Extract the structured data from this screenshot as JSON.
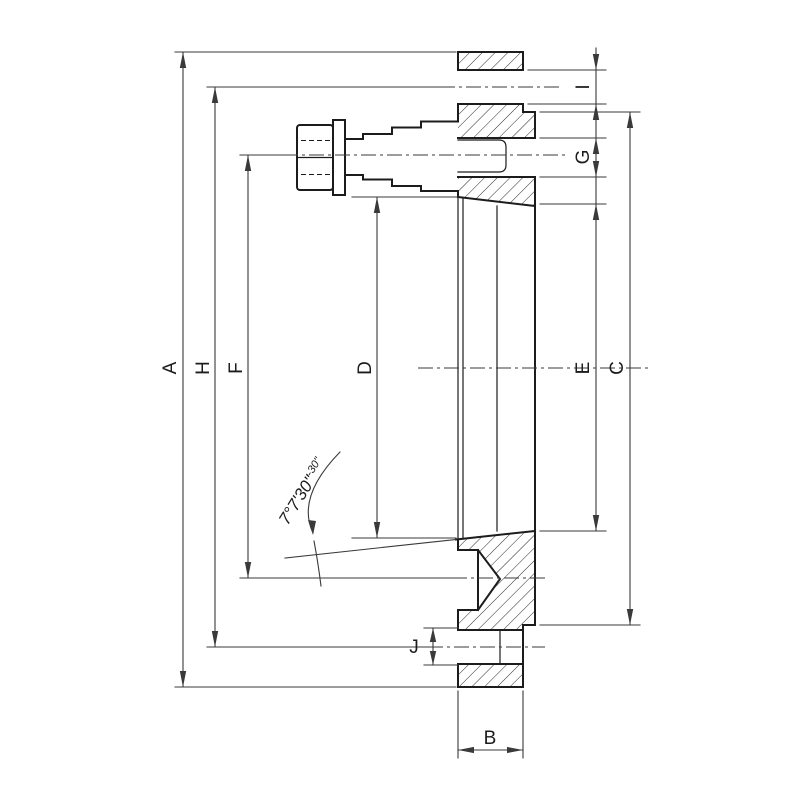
{
  "drawing": {
    "labels": {
      "a": "A",
      "b": "B",
      "c": "C",
      "d": "D",
      "e": "E",
      "f": "F",
      "g": "G",
      "h": "H",
      "i": "I",
      "j": "J"
    },
    "angle": {
      "value": "7°7'30\"",
      "tolerance": "-30\""
    },
    "colors": {
      "outline": "#1c1c1c",
      "dimension": "#3a3a3a",
      "background": "#ffffff"
    }
  }
}
